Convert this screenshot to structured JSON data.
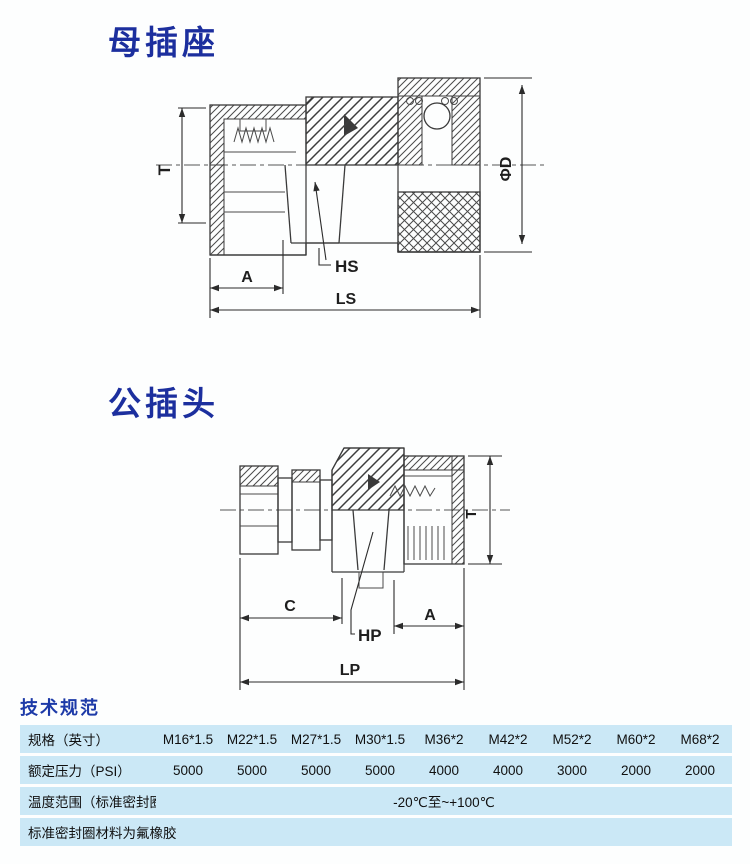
{
  "sections": {
    "female_title": "母插座",
    "male_title": "公插头",
    "specs_title": "技术规范"
  },
  "drawing_female": {
    "dim_t": "T",
    "dim_d": "ΦD",
    "dim_a": "A",
    "dim_ls": "LS",
    "label_hs": "HS"
  },
  "drawing_male": {
    "dim_t": "T",
    "dim_c": "C",
    "dim_a": "A",
    "dim_lp": "LP",
    "label_hp": "HP"
  },
  "spec_table": {
    "row_spec_label": "规格（英寸）",
    "row_spec_values": [
      "M16*1.5",
      "M22*1.5",
      "M27*1.5",
      "M30*1.5",
      "M36*2",
      "M42*2",
      "M52*2",
      "M60*2",
      "M68*2"
    ],
    "row_pressure_label": "额定压力（PSI）",
    "row_pressure_values": [
      "5000",
      "5000",
      "5000",
      "5000",
      "4000",
      "4000",
      "3000",
      "2000",
      "2000"
    ],
    "row_temp_label": "温度范围（标准密封圈）",
    "row_temp_value": "-20℃至~+100℃",
    "row_material_label": "标准密封圈材料为氟橡胶"
  },
  "colors": {
    "title_blue": "#1c2f9e",
    "specs_title_blue": "#1d3aa8",
    "table_row_bg": "#cbe8f6",
    "drawing_line": "#3a3a3a"
  }
}
